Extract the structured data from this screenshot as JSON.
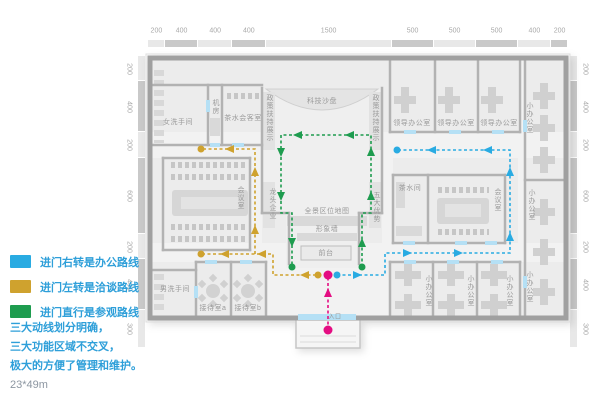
{
  "legend": {
    "items": [
      {
        "id": "office",
        "label": "进门右转是办公路线",
        "color": "#29ABE2"
      },
      {
        "id": "negotiation",
        "label": "进门左转是洽谈路线",
        "color": "#CFA22E"
      },
      {
        "id": "visit",
        "label": "进门直行是参观路线",
        "color": "#1E9C4F"
      }
    ]
  },
  "notes": {
    "line1": "三大动线划分明确，",
    "line2": "三大功能区域不交叉，",
    "line3": "极大的方便了管理和维护。",
    "dimensions": "23*49m"
  },
  "rulers": {
    "top": [
      "200",
      "400",
      "400",
      "400",
      "1500",
      "500",
      "500",
      "500",
      "400",
      "200"
    ],
    "left": [
      "200",
      "400",
      "200",
      "600",
      "200",
      "400",
      "300"
    ],
    "right": [
      "200",
      "400",
      "200",
      "600",
      "200",
      "400",
      "300"
    ]
  },
  "routes": {
    "office": {
      "name": "办公路线",
      "color": "#29ABE2"
    },
    "negotiation": {
      "name": "洽谈路线",
      "color": "#CFA22E"
    },
    "visit": {
      "name": "参观路线",
      "color": "#1E9C4F"
    },
    "entrance": {
      "name": "入口路线",
      "color": "#E40D82"
    }
  },
  "plan": {
    "rooms": [
      {
        "t": "女洗手间",
        "x": 178,
        "y": 122
      },
      {
        "t": "机房",
        "x": 215,
        "y": 107,
        "v": 1
      },
      {
        "t": "茶水会客室",
        "x": 243,
        "y": 118
      },
      {
        "t": "科技沙盘",
        "x": 322,
        "y": 101
      },
      {
        "t": "政策扶持展示",
        "x": 269,
        "y": 118,
        "v": 1
      },
      {
        "t": "政策扶持展示",
        "x": 375,
        "y": 118,
        "v": 1
      },
      {
        "t": "领导办公室",
        "x": 412,
        "y": 123
      },
      {
        "t": "领导办公室",
        "x": 456,
        "y": 123
      },
      {
        "t": "领导办公室",
        "x": 499,
        "y": 123
      },
      {
        "t": "小办公室",
        "x": 529,
        "y": 118,
        "v": 1
      },
      {
        "t": "茶水间",
        "x": 410,
        "y": 188
      },
      {
        "t": "会议室",
        "x": 497,
        "y": 200,
        "v": 1
      },
      {
        "t": "小办公室",
        "x": 531,
        "y": 205,
        "v": 1
      },
      {
        "t": "会议室",
        "x": 240,
        "y": 198,
        "v": 1
      },
      {
        "t": "龙头企业",
        "x": 272,
        "y": 204,
        "v": 1
      },
      {
        "t": "五大优势",
        "x": 376,
        "y": 207,
        "v": 1
      },
      {
        "t": "全景区位地图",
        "x": 327,
        "y": 211
      },
      {
        "t": "形象墙",
        "x": 327,
        "y": 229
      },
      {
        "t": "前台",
        "x": 326,
        "y": 253
      },
      {
        "t": "男洗手间",
        "x": 175,
        "y": 289
      },
      {
        "t": "接待室a",
        "x": 213,
        "y": 308
      },
      {
        "t": "接待室b",
        "x": 248,
        "y": 308
      },
      {
        "t": "小办公室",
        "x": 428,
        "y": 291,
        "v": 1
      },
      {
        "t": "小办公室",
        "x": 470,
        "y": 291,
        "v": 1
      },
      {
        "t": "小办公室",
        "x": 509,
        "y": 291,
        "v": 1
      },
      {
        "t": "小办公室",
        "x": 529,
        "y": 287,
        "v": 1
      },
      {
        "t": "入口",
        "x": 335,
        "y": 316,
        "fs": 6
      }
    ]
  }
}
